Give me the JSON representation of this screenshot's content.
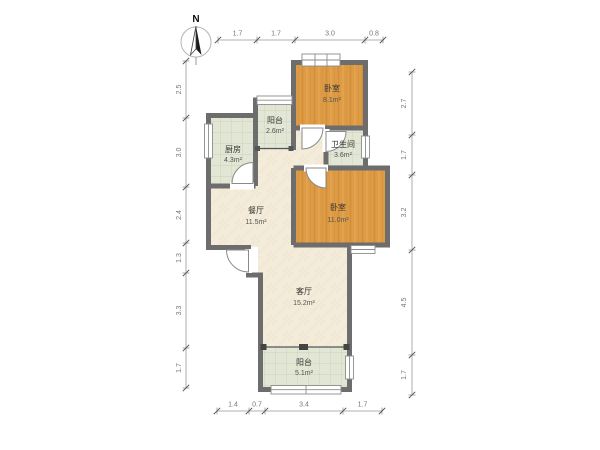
{
  "compass": {
    "north_label": "N"
  },
  "rooms": {
    "bedroom_top": {
      "name": "卧室",
      "area": "8.1m²"
    },
    "balcony_top": {
      "name": "阳台",
      "area": "2.6m²"
    },
    "kitchen": {
      "name": "厨房",
      "area": "4.3m²"
    },
    "bathroom": {
      "name": "卫生间",
      "area": "3.6m²"
    },
    "bedroom_right": {
      "name": "卧室",
      "area": "11.0m²"
    },
    "dining": {
      "name": "餐厅",
      "area": "11.5m²"
    },
    "living": {
      "name": "客厅",
      "area": "15.2m²"
    },
    "balcony_bottom": {
      "name": "阳台",
      "area": "5.1m²"
    }
  },
  "dimensions": {
    "top": [
      "1.7",
      "1.7",
      "3.0",
      "0.8"
    ],
    "bottom": [
      "1.4",
      "0.7",
      "3.4",
      "1.7"
    ],
    "left": [
      "2.5",
      "3.0",
      "2.4",
      "1.3",
      "3.3",
      "1.7"
    ],
    "right": [
      "2.7",
      "1.7",
      "3.2",
      "4.5",
      "1.7"
    ]
  },
  "colors": {
    "wall": "#6d6d6d",
    "wood_floor": "#de9b45",
    "wood_grain": "#c9822f",
    "tile_floor": "#e2e6d4",
    "tile_grid": "#c6ccb2",
    "cream_floor": "#f4ecda",
    "dimension_line": "#999999",
    "dimension_text": "#777777"
  }
}
